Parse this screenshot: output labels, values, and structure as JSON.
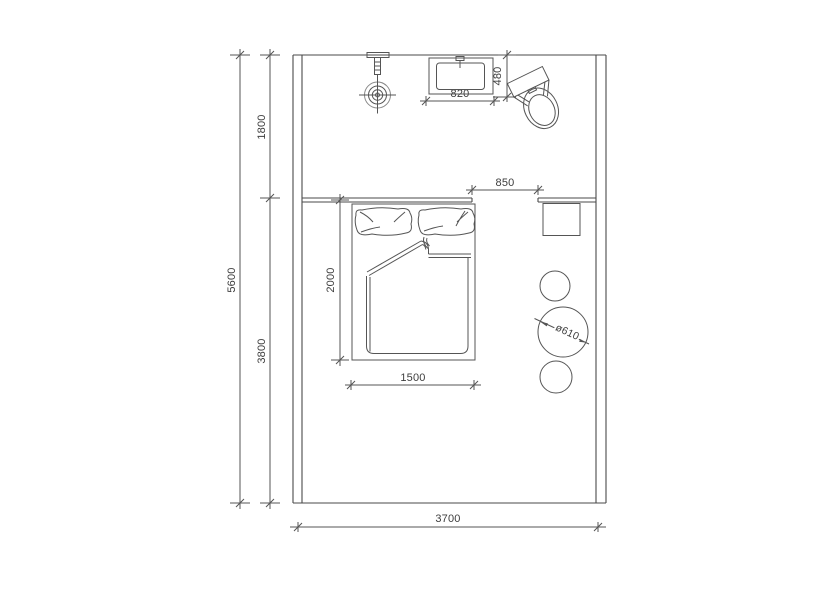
{
  "drawing": {
    "colors": {
      "background": "#ffffff",
      "wall": "#4a4a4a",
      "line": "#555555",
      "light_line": "#8a8a8a",
      "text": "#3d3d3d"
    },
    "dims": {
      "total_height": "5600",
      "upper_zone_height": "1800",
      "lower_zone_height": "3800",
      "room_width": "3700",
      "bed_length": "2000",
      "bed_width": "1500",
      "vanity_width": "820",
      "vanity_depth": "480",
      "wall_opening": "850",
      "stool_diameter": "ø610"
    }
  }
}
